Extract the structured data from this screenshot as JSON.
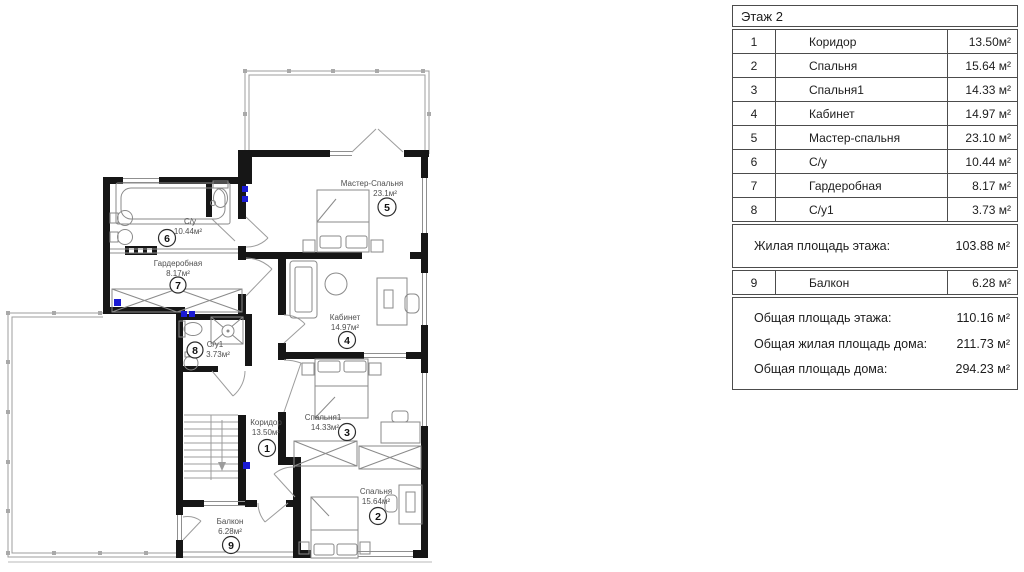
{
  "colors": {
    "wall": "#161616",
    "electric": "#1b1bd4"
  },
  "plan": {
    "rooms": [
      {
        "num": "1",
        "name": "Коридор",
        "area": "13.50м²"
      },
      {
        "num": "2",
        "name": "Спальня",
        "area": "15.64м²"
      },
      {
        "num": "3",
        "name": "Спальня1",
        "area": "14.33м²"
      },
      {
        "num": "4",
        "name": "Кабинет",
        "area": "14.97м²"
      },
      {
        "num": "5",
        "name": "Мастер-Спальня",
        "area": "23.1м²"
      },
      {
        "num": "6",
        "name": "С/у",
        "area": "10.44м²"
      },
      {
        "num": "7",
        "name": "Гардеробная",
        "area": "8.17м²"
      },
      {
        "num": "8",
        "name": "С/у1",
        "area": "3.73м²"
      },
      {
        "num": "9",
        "name": "Балкон",
        "area": "6.28м²"
      }
    ]
  },
  "table": {
    "title": "Этаж 2",
    "rows": [
      {
        "num": "1",
        "name": "Коридор",
        "area": "13.50м²"
      },
      {
        "num": "2",
        "name": "Спальня",
        "area": "15.64 м²"
      },
      {
        "num": "3",
        "name": "Спальня1",
        "area": "14.33 м²"
      },
      {
        "num": "4",
        "name": "Кабинет",
        "area": "14.97 м²"
      },
      {
        "num": "5",
        "name": "Мастер-спальня",
        "area": "23.10 м²"
      },
      {
        "num": "6",
        "name": "С/у",
        "area": "10.44 м²"
      },
      {
        "num": "7",
        "name": "Гардеробная",
        "area": "8.17 м²"
      },
      {
        "num": "8",
        "name": "С/у1",
        "area": "3.73 м²"
      }
    ],
    "living_total": {
      "label": "Жилая площадь этажа:",
      "value": "103.88 м²"
    },
    "balcony_row": {
      "num": "9",
      "name": "Балкон",
      "area": "6.28 м²"
    },
    "totals": [
      {
        "label": "Общая площадь этажа:",
        "value": "110.16 м²"
      },
      {
        "label": "Общая жилая площадь дома:",
        "value": "211.73 м²"
      },
      {
        "label": "Общая площадь дома:",
        "value": "294.23 м²"
      }
    ]
  }
}
